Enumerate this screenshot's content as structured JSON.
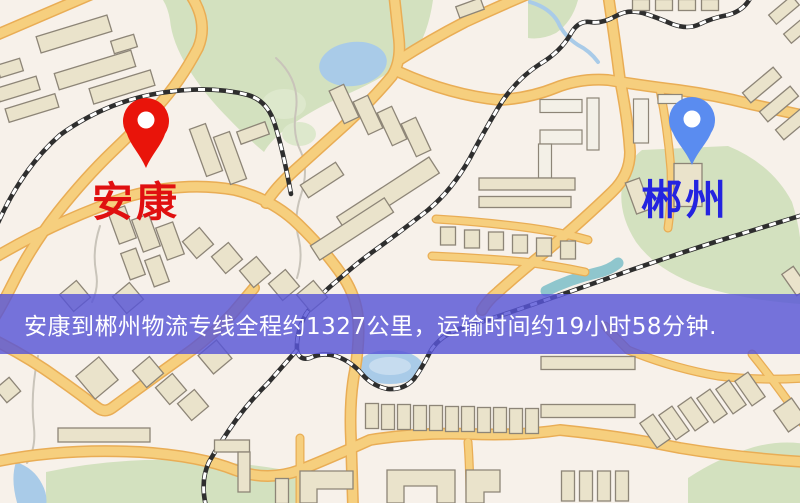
{
  "map": {
    "origin": {
      "name": "安康",
      "pin_icon": "red-map-pin-icon"
    },
    "destination": {
      "name": "郴州",
      "pin_icon": "blue-map-pin-icon"
    }
  },
  "banner": {
    "text": "安康到郴州物流专线全程约1327公里，运输时间约19小时58分钟.",
    "distance_km": "1327",
    "duration": "19小时58分钟"
  },
  "colors": {
    "map_background": "#f7f1ea",
    "road_fill": "#f6cf7e",
    "road_casing": "#e9ad55",
    "park": "#d3e1bf",
    "park_light": "#dde8cc",
    "water": "#a9cbe8",
    "water_light": "#c6dcef",
    "teal_stream": "#8fc6cd",
    "building_fill": "#eae3cb",
    "building_white": "#f3f0e7",
    "building_stroke": "#8d8577",
    "railway_dark": "#2e2e2e",
    "railway_light": "#ffffff",
    "path_gray": "#c9c4ba",
    "banner_background": "rgba(88,86,215,0.82)",
    "banner_text": "#ffffff",
    "origin_pin": "#e9140a",
    "origin_label": "#e01010",
    "destination_pin": "#5a8cf0",
    "destination_label": "#2424e0"
  }
}
